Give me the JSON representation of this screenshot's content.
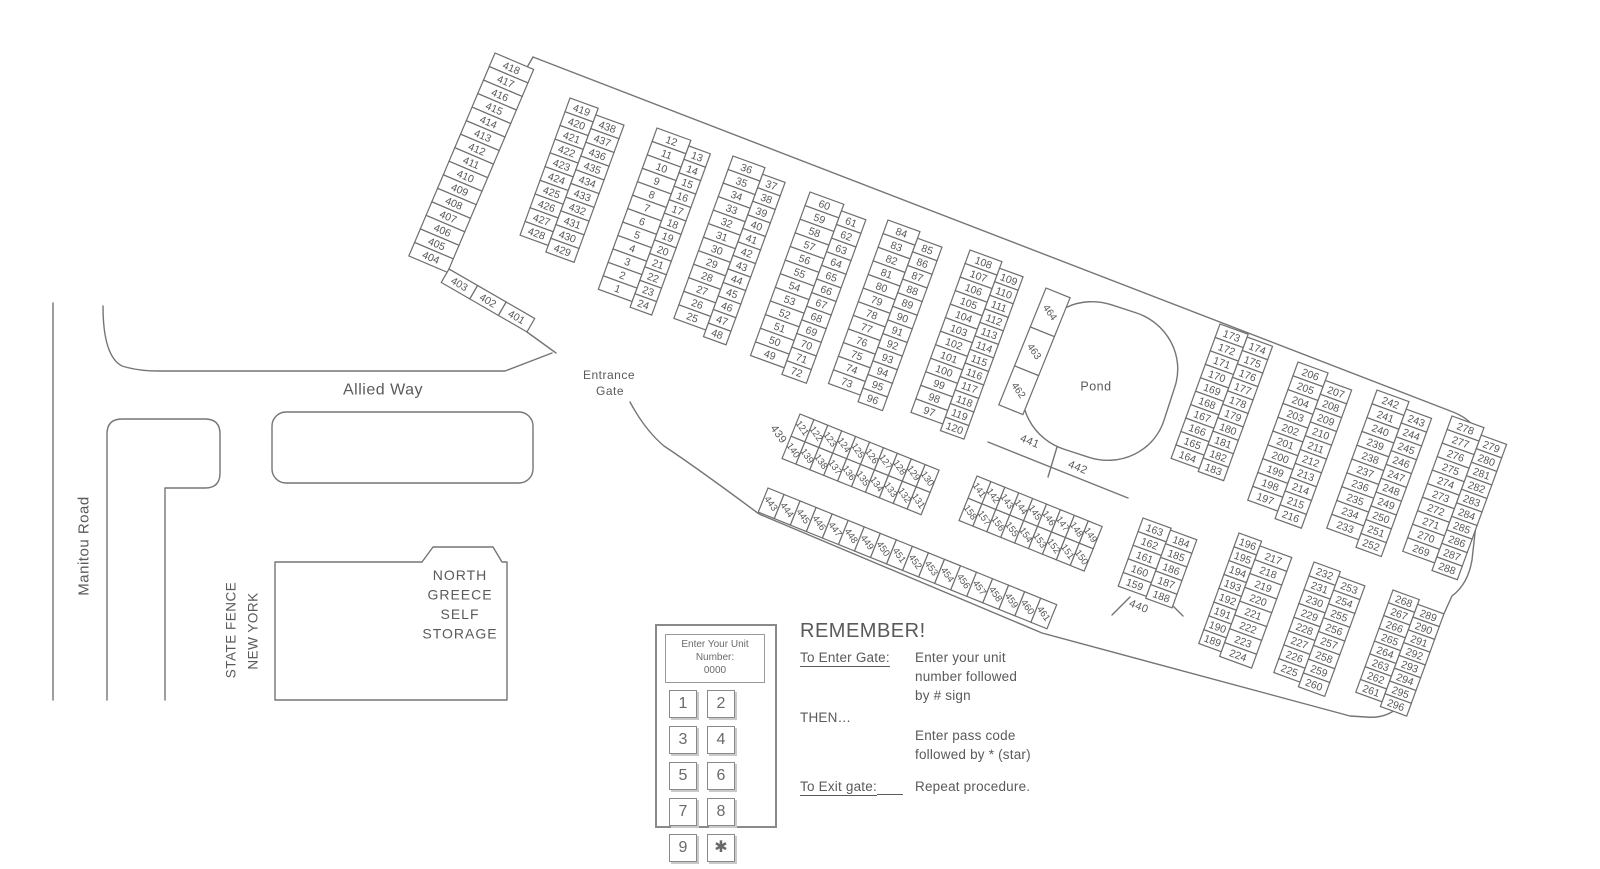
{
  "map_labels": {
    "pond": "Pond",
    "allied_way": "Allied Way",
    "manitou_road": "Manitou Road",
    "fence_line_right": "NEW YORK",
    "fence_line_left": "STATE FENCE",
    "entrance_line1": "Entrance",
    "entrance_line2": "Gate",
    "road439": "439",
    "road440": "440",
    "road441": "441",
    "road442": "442"
  },
  "building_lines": [
    "NORTH",
    "GREECE",
    "SELF",
    "STORAGE"
  ],
  "keypad": {
    "display": [
      "Enter Your Unit",
      "Number:",
      "0000"
    ],
    "keys": [
      "1",
      "2",
      "3",
      "4",
      "5",
      "6",
      "7",
      "8",
      "9",
      "✱",
      "0",
      "#"
    ]
  },
  "instructions": {
    "heading": "REMEMBER!",
    "enter_label": "To Enter Gate:",
    "enter_lines": [
      "Enter your unit",
      "number followed",
      "by # sign"
    ],
    "then_label": "THEN…",
    "pass_lines": [
      "Enter pass code",
      "followed by * (star)"
    ],
    "exit_label": "To Exit gate:",
    "exit_text": "Repeat procedure."
  },
  "blocks": {
    "s404": {
      "columns": [
        [
          "418",
          "417",
          "416",
          "415",
          "414",
          "413",
          "412",
          "411",
          "410",
          "409",
          "408",
          "407",
          "406",
          "405",
          "404"
        ]
      ]
    },
    "s401": {
      "columns": [
        [
          "403"
        ],
        [
          "402"
        ],
        [
          "401"
        ]
      ]
    },
    "b419": {
      "columns": [
        [
          "419",
          "420",
          "421",
          "422",
          "423",
          "424",
          "425",
          "426",
          "427",
          "428"
        ],
        [
          "438",
          "437",
          "436",
          "435",
          "434",
          "433",
          "432",
          "431",
          "430",
          "429"
        ]
      ]
    },
    "b1": {
      "columns": [
        [
          "12",
          "11",
          "10",
          "9",
          "8",
          "7",
          "6",
          "5",
          "4",
          "3",
          "2",
          "1"
        ],
        [
          "13",
          "14",
          "15",
          "16",
          "17",
          "18",
          "19",
          "20",
          "21",
          "22",
          "23",
          "24"
        ]
      ]
    },
    "b25": {
      "columns": [
        [
          "36",
          "35",
          "34",
          "33",
          "32",
          "31",
          "30",
          "29",
          "28",
          "27",
          "26",
          "25"
        ],
        [
          "37",
          "38",
          "39",
          "40",
          "41",
          "42",
          "43",
          "44",
          "45",
          "46",
          "47",
          "48"
        ]
      ]
    },
    "b49": {
      "columns": [
        [
          "60",
          "59",
          "58",
          "57",
          "56",
          "55",
          "54",
          "53",
          "52",
          "51",
          "50",
          "49"
        ],
        [
          "61",
          "62",
          "63",
          "64",
          "65",
          "66",
          "67",
          "68",
          "69",
          "70",
          "71",
          "72"
        ]
      ]
    },
    "b73": {
      "columns": [
        [
          "84",
          "83",
          "82",
          "81",
          "80",
          "79",
          "78",
          "77",
          "76",
          "75",
          "74",
          "73"
        ],
        [
          "85",
          "86",
          "87",
          "88",
          "89",
          "90",
          "91",
          "92",
          "93",
          "94",
          "95",
          "96"
        ]
      ]
    },
    "b97": {
      "columns": [
        [
          "108",
          "107",
          "106",
          "105",
          "104",
          "103",
          "102",
          "101",
          "100",
          "99",
          "98",
          "97"
        ],
        [
          "109",
          "110",
          "111",
          "112",
          "113",
          "114",
          "115",
          "116",
          "117",
          "118",
          "119",
          "120"
        ]
      ]
    },
    "b164": {
      "columns": [
        [
          "173",
          "172",
          "171",
          "170",
          "169",
          "168",
          "167",
          "166",
          "165",
          "164"
        ],
        [
          "174",
          "175",
          "176",
          "177",
          "178",
          "179",
          "180",
          "181",
          "182",
          "183"
        ]
      ]
    },
    "b197": {
      "columns": [
        [
          "206",
          "205",
          "204",
          "203",
          "202",
          "201",
          "200",
          "199",
          "198",
          "197"
        ],
        [
          "207",
          "208",
          "209",
          "210",
          "211",
          "212",
          "213",
          "214",
          "215",
          "216"
        ]
      ]
    },
    "b233": {
      "columns": [
        [
          "242",
          "241",
          "240",
          "239",
          "238",
          "237",
          "236",
          "235",
          "234",
          "233"
        ],
        [
          "243",
          "244",
          "245",
          "246",
          "247",
          "248",
          "249",
          "250",
          "251",
          "252"
        ]
      ]
    },
    "b269": {
      "columns": [
        [
          "278",
          "277",
          "276",
          "275",
          "274",
          "273",
          "272",
          "271",
          "270",
          "269"
        ],
        [
          "279",
          "280",
          "281",
          "282",
          "283",
          "284",
          "285",
          "286",
          "287",
          "288"
        ]
      ]
    },
    "b159": {
      "columns": [
        [
          "163",
          "162",
          "161",
          "160",
          "159"
        ],
        [
          "184",
          "185",
          "186",
          "187",
          "188"
        ]
      ]
    },
    "b189": {
      "columns": [
        [
          "196",
          "195",
          "194",
          "193",
          "192",
          "191",
          "190",
          "189"
        ],
        [
          "217",
          "218",
          "219",
          "220",
          "221",
          "222",
          "223",
          "224"
        ]
      ]
    },
    "b225": {
      "columns": [
        [
          "232",
          "231",
          "230",
          "229",
          "228",
          "227",
          "226",
          "225"
        ],
        [
          "253",
          "254",
          "255",
          "256",
          "257",
          "258",
          "259",
          "260"
        ]
      ]
    },
    "b261": {
      "columns": [
        [
          "268",
          "267",
          "266",
          "265",
          "264",
          "263",
          "262",
          "261"
        ],
        [
          "289",
          "290",
          "291",
          "292",
          "293",
          "294",
          "295",
          "296"
        ]
      ]
    },
    "strip121": {
      "columns": [
        [
          "121",
          "140"
        ],
        [
          "122",
          "139"
        ],
        [
          "123",
          "138"
        ],
        [
          "124",
          "137"
        ],
        [
          "125",
          "136"
        ],
        [
          "126",
          "135"
        ],
        [
          "127",
          "134"
        ],
        [
          "128",
          "133"
        ],
        [
          "129",
          "132"
        ],
        [
          "130",
          "131"
        ]
      ]
    },
    "strip141": {
      "columns": [
        [
          "141",
          "158"
        ],
        [
          "142",
          "157"
        ],
        [
          "143",
          "156"
        ],
        [
          "144",
          "155"
        ],
        [
          "145",
          "154"
        ],
        [
          "146",
          "153"
        ],
        [
          "147",
          "152"
        ],
        [
          "148",
          "151"
        ],
        [
          "149",
          "150"
        ]
      ]
    },
    "strip443": {
      "columns": [
        [
          "443"
        ],
        [
          "444"
        ],
        [
          "445"
        ],
        [
          "446"
        ],
        [
          "447"
        ],
        [
          "448"
        ],
        [
          "449"
        ],
        [
          "450"
        ],
        [
          "451"
        ],
        [
          "452"
        ],
        [
          "453"
        ],
        [
          "454"
        ],
        [
          "456"
        ],
        [
          "457"
        ],
        [
          "458"
        ],
        [
          "459"
        ],
        [
          "460"
        ],
        [
          "461"
        ]
      ]
    },
    "strip462": {
      "columns": [
        [
          "464",
          "463",
          "462"
        ]
      ]
    }
  }
}
